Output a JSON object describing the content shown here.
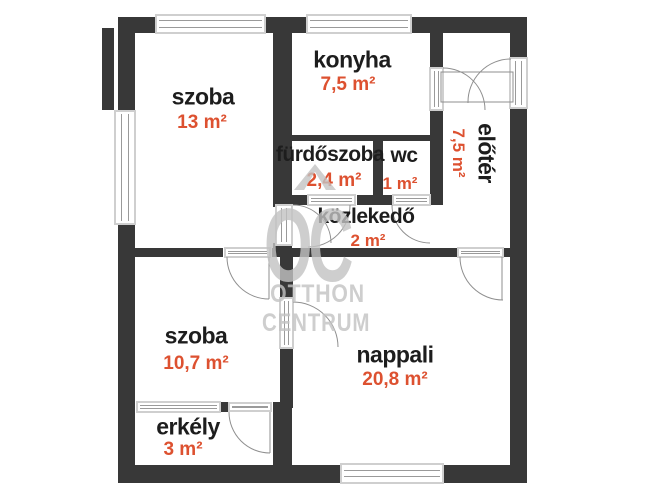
{
  "plan_title": "apartment floor plan",
  "colors": {
    "wall": "#383838",
    "ink": "#1d1d1d",
    "accent": "#dd5130",
    "watermark": "#c3c3c3",
    "arc": "#8f8f8f"
  },
  "rooms": {
    "szoba_top": {
      "name": "szoba",
      "area": "13 m²"
    },
    "konyha": {
      "name": "konyha",
      "area": "7,5 m²"
    },
    "eloter": {
      "name": "előtér",
      "area": "7,5 m²"
    },
    "furdoszoba": {
      "name": "fürdőszoba",
      "area": "2,4 m²"
    },
    "wc": {
      "name": "wc",
      "area": "1 m²"
    },
    "kozlekedo": {
      "name": "közlekedő",
      "area": "2 m²"
    },
    "szoba_bottom": {
      "name": "szoba",
      "area": "10,7 m²"
    },
    "nappali": {
      "name": "nappali",
      "area": "20,8 m²"
    },
    "erkely": {
      "name": "erkély",
      "area": "3 m²"
    }
  },
  "watermark": {
    "monogram": "OC",
    "line1": "OTTHON",
    "line2": "CENTRUM"
  }
}
